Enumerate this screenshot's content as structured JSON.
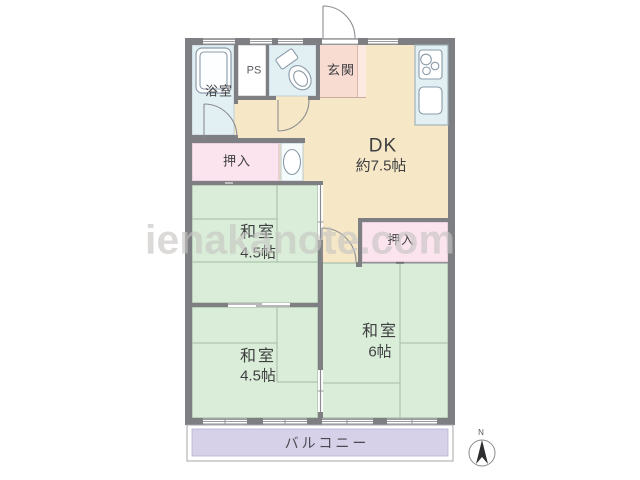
{
  "watermark": "ienakanote.com",
  "compass": {
    "label": "N"
  },
  "rooms": {
    "bathroom": {
      "label": "浴室"
    },
    "pipe_space": {
      "label": "PS"
    },
    "entrance": {
      "label": "玄関"
    },
    "dining_kitchen": {
      "label": "DK",
      "size": "約7.5帖"
    },
    "closet_1": {
      "label": "押入"
    },
    "closet_2": {
      "label": "押入"
    },
    "japanese_room_upper": {
      "label": "和室",
      "size": "4.5帖"
    },
    "japanese_room_lower": {
      "label": "和室",
      "size": "4.5帖"
    },
    "japanese_room_right": {
      "label": "和室",
      "size": "6帖"
    },
    "balcony": {
      "label": "バルコニー"
    }
  },
  "fixtures": [
    "bathtub",
    "toilet",
    "washbasin",
    "stove",
    "kitchen-sink",
    "compass-needle"
  ],
  "colors": {
    "wall": "#7e7f83",
    "wall_line": "#8a8b8f",
    "water": "#e2f0f4",
    "white_room": "#ffffff",
    "entrance": "#f8dcd2",
    "entrance_step": "#fbe9e2",
    "dk": "#f6e8c6",
    "closet": "#fbe4ee",
    "tatami": "#d9edd8",
    "tatami_line": "#a3bca4",
    "balcony": "#d6d0e8",
    "fixture": "#8a9aa8",
    "text": "#3f3f42",
    "watermark": "#c7c5c3"
  }
}
